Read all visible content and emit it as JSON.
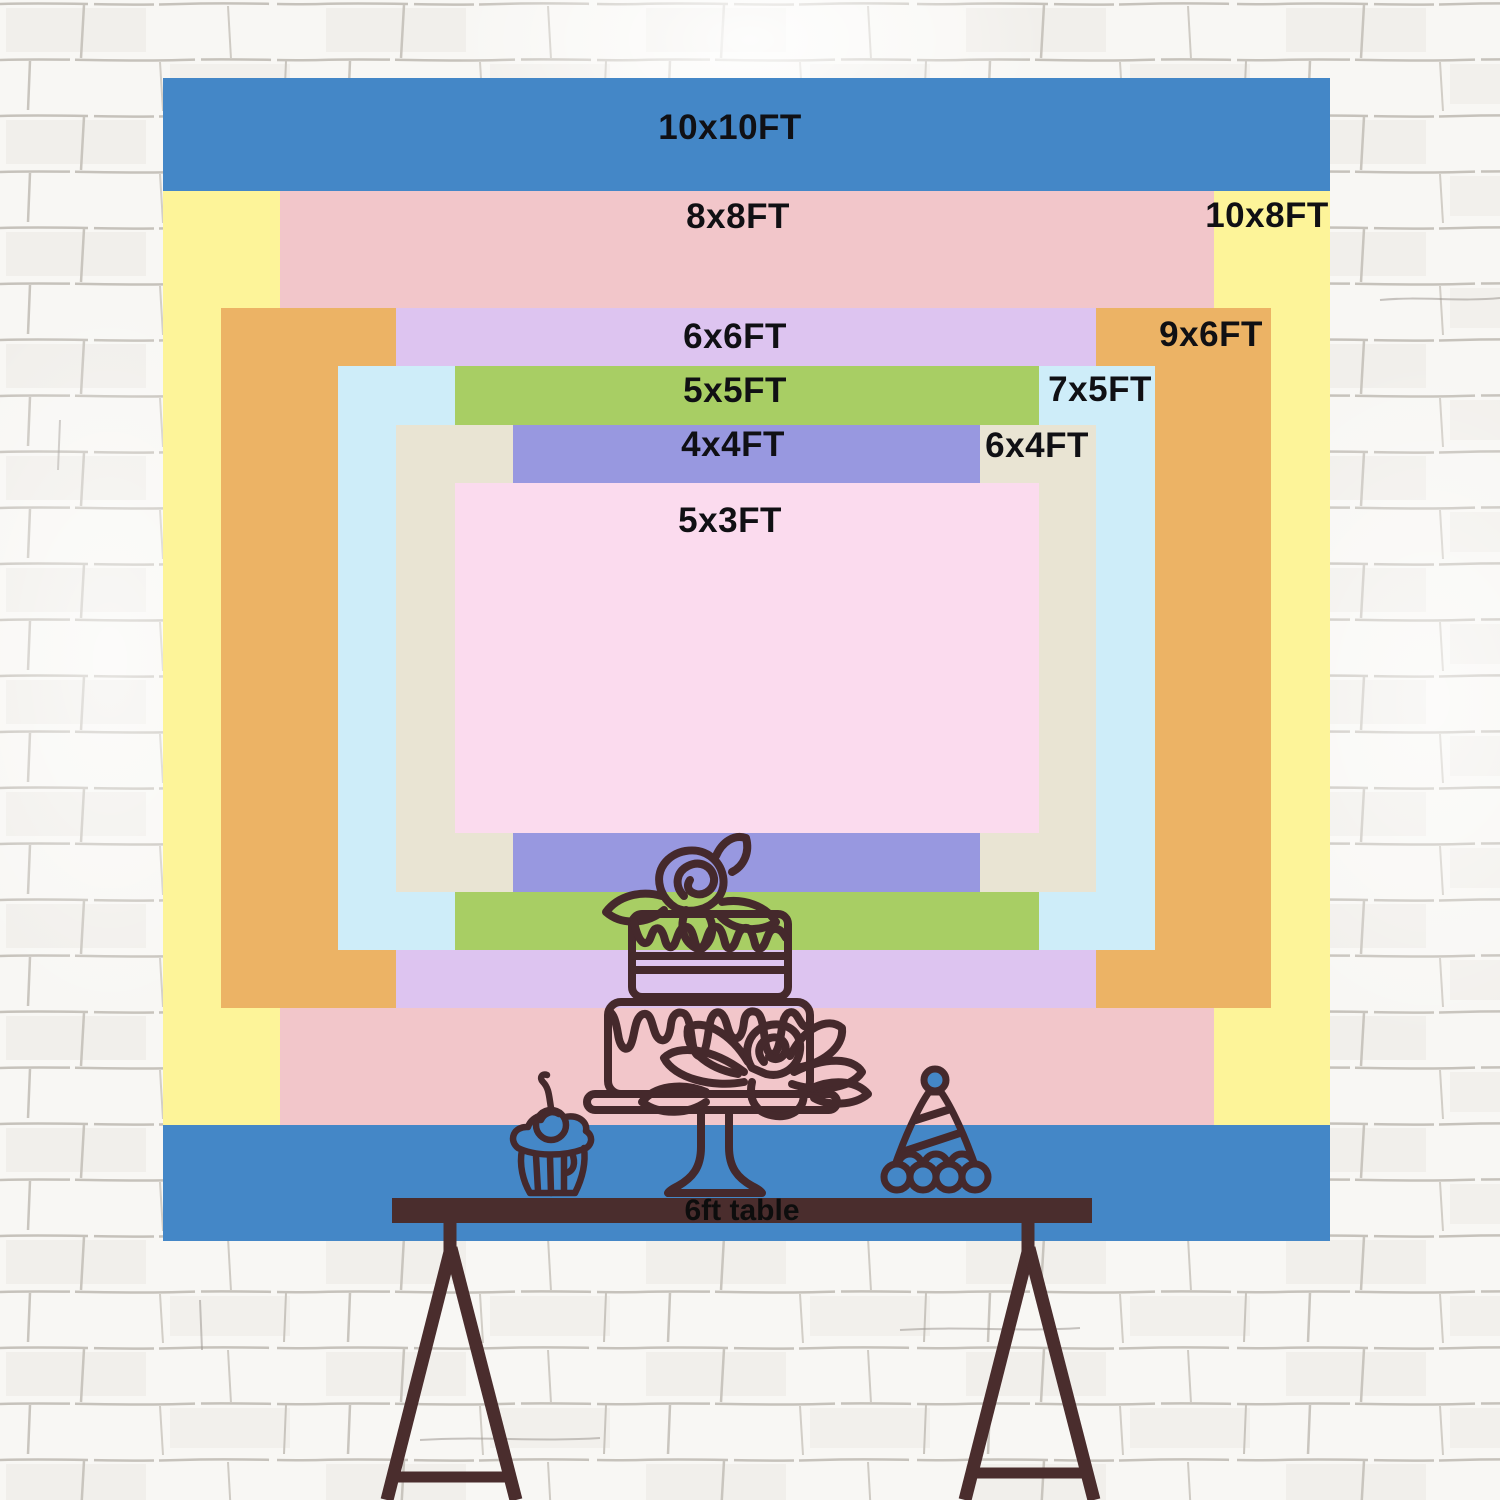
{
  "scene": {
    "type": "backdrop-size-comparison-chart",
    "wall": "white-brick-wall"
  },
  "sizes": [
    {
      "label": "10x10FT",
      "width_ft": 10,
      "height_ft": 10,
      "color": "#4487c7",
      "label_placement": "top-center"
    },
    {
      "label": "10x8FT",
      "width_ft": 10,
      "height_ft": 8,
      "color": "#fdf499",
      "label_placement": "top-right"
    },
    {
      "label": "8x8FT",
      "width_ft": 8,
      "height_ft": 8,
      "color": "#f2c6ca",
      "label_placement": "top-center"
    },
    {
      "label": "9x6FT",
      "width_ft": 9,
      "height_ft": 6,
      "color": "#ecb365",
      "label_placement": "top-right"
    },
    {
      "label": "6x6FT",
      "width_ft": 6,
      "height_ft": 6,
      "color": "#ddc4f0",
      "label_placement": "top-center"
    },
    {
      "label": "7x5FT",
      "width_ft": 7,
      "height_ft": 5,
      "color": "#ceedf9",
      "label_placement": "top-right"
    },
    {
      "label": "5x5FT",
      "width_ft": 5,
      "height_ft": 5,
      "color": "#a8ce64",
      "label_placement": "top-center"
    },
    {
      "label": "6x4FT",
      "width_ft": 6,
      "height_ft": 4,
      "color": "#e9e4d3",
      "label_placement": "top-right"
    },
    {
      "label": "4x4FT",
      "width_ft": 4,
      "height_ft": 4,
      "color": "#9898e0",
      "label_placement": "top-center"
    },
    {
      "label": "5x3FT",
      "width_ft": 5,
      "height_ft": 3,
      "color": "#fbdbee",
      "label_placement": "top-center"
    }
  ],
  "table": {
    "label": "6ft table",
    "color": "#4a2d2d"
  },
  "illustrations": {
    "cake": "two-tier-cake-on-stand",
    "cupcake": "cupcake-with-cherry",
    "party_hat": "striped-party-hat",
    "line_color": "#45292c"
  }
}
